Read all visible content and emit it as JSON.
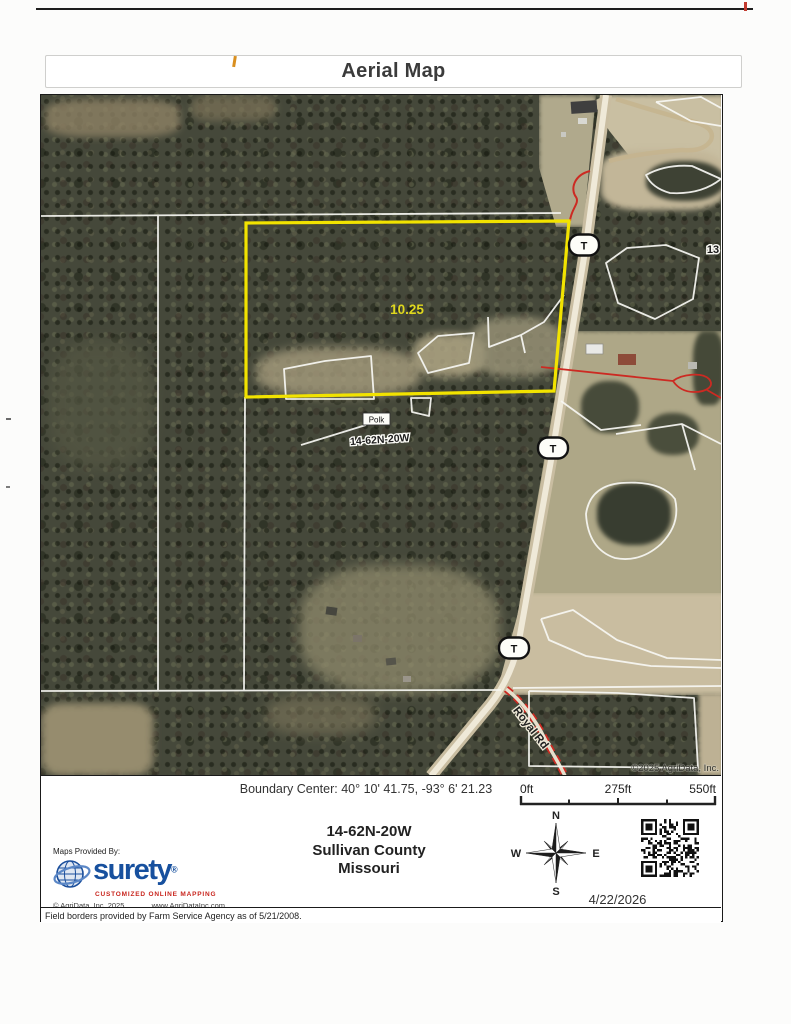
{
  "title": "Aerial Map",
  "map": {
    "acreage_label": "10.25",
    "road_markers": [
      "T",
      "T",
      "T"
    ],
    "road_name": "Royal Rd",
    "section_number": "13",
    "place_label": "Polk",
    "township_label": "14-62N-20W",
    "imagery_copyright": "©2025 AgriData, Inc."
  },
  "footer": {
    "boundary_center": "Boundary Center: 40° 10' 41.75, -93° 6' 21.23",
    "scale_ticks": [
      "0ft",
      "275ft",
      "550ft"
    ],
    "location_lines": [
      "14-62N-20W",
      "Sullivan County",
      "Missouri"
    ],
    "compass": {
      "north": "N",
      "south": "S",
      "east": "E",
      "west": "W"
    },
    "date": "4/22/2026",
    "provider": {
      "heading": "Maps Provided By:",
      "brand": "surety",
      "registered_mark": "®",
      "tagline": "CUSTOMIZED ONLINE MAPPING",
      "copyright": "© AgriData, Inc. 2025",
      "website": "www.AgriDataInc.com"
    },
    "disclaimer": "Field borders provided by Farm Service Agency as of 5/21/2008."
  },
  "colors": {
    "boundary_yellow": "#f2e300",
    "overlay_red": "#cc2a22",
    "brand_blue": "#17509e",
    "tagline_red": "#c8251d"
  }
}
